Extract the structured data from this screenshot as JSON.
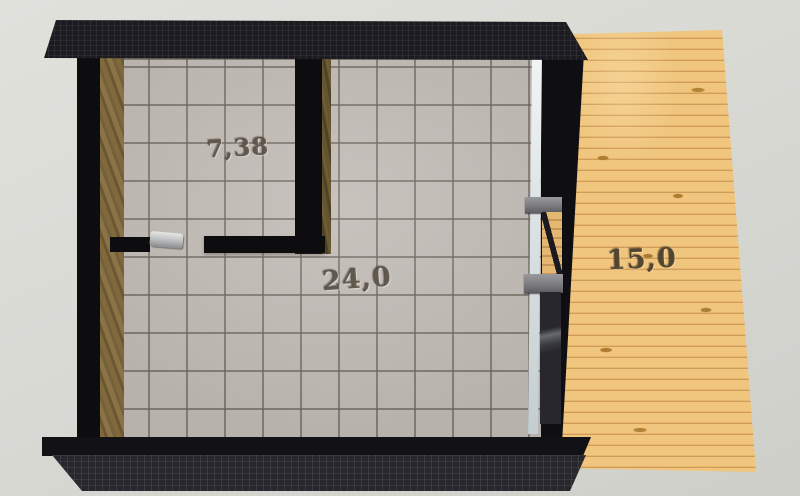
{
  "scene": {
    "type": "3d-floor-plan-render",
    "rooms": [
      {
        "name": "small-room",
        "area_label": "7,38"
      },
      {
        "name": "main-room",
        "area_label": "24,0"
      },
      {
        "name": "terrace",
        "area_label": "15,0"
      }
    ],
    "colors": {
      "background": "#d8d8d3",
      "roof_dark": "#1b1b20",
      "wall_black": "#0d0d10",
      "wall_wood_face": "#76653c",
      "floor_tile": "#c2bcb6",
      "tile_grout": "#8e8780",
      "deck_wood": "#eec077",
      "deck_plank_line": "#cf9c5c",
      "glass": "#e6eaec",
      "door_frame_gray": "#808084",
      "label_engraved": "#5a5042"
    }
  }
}
